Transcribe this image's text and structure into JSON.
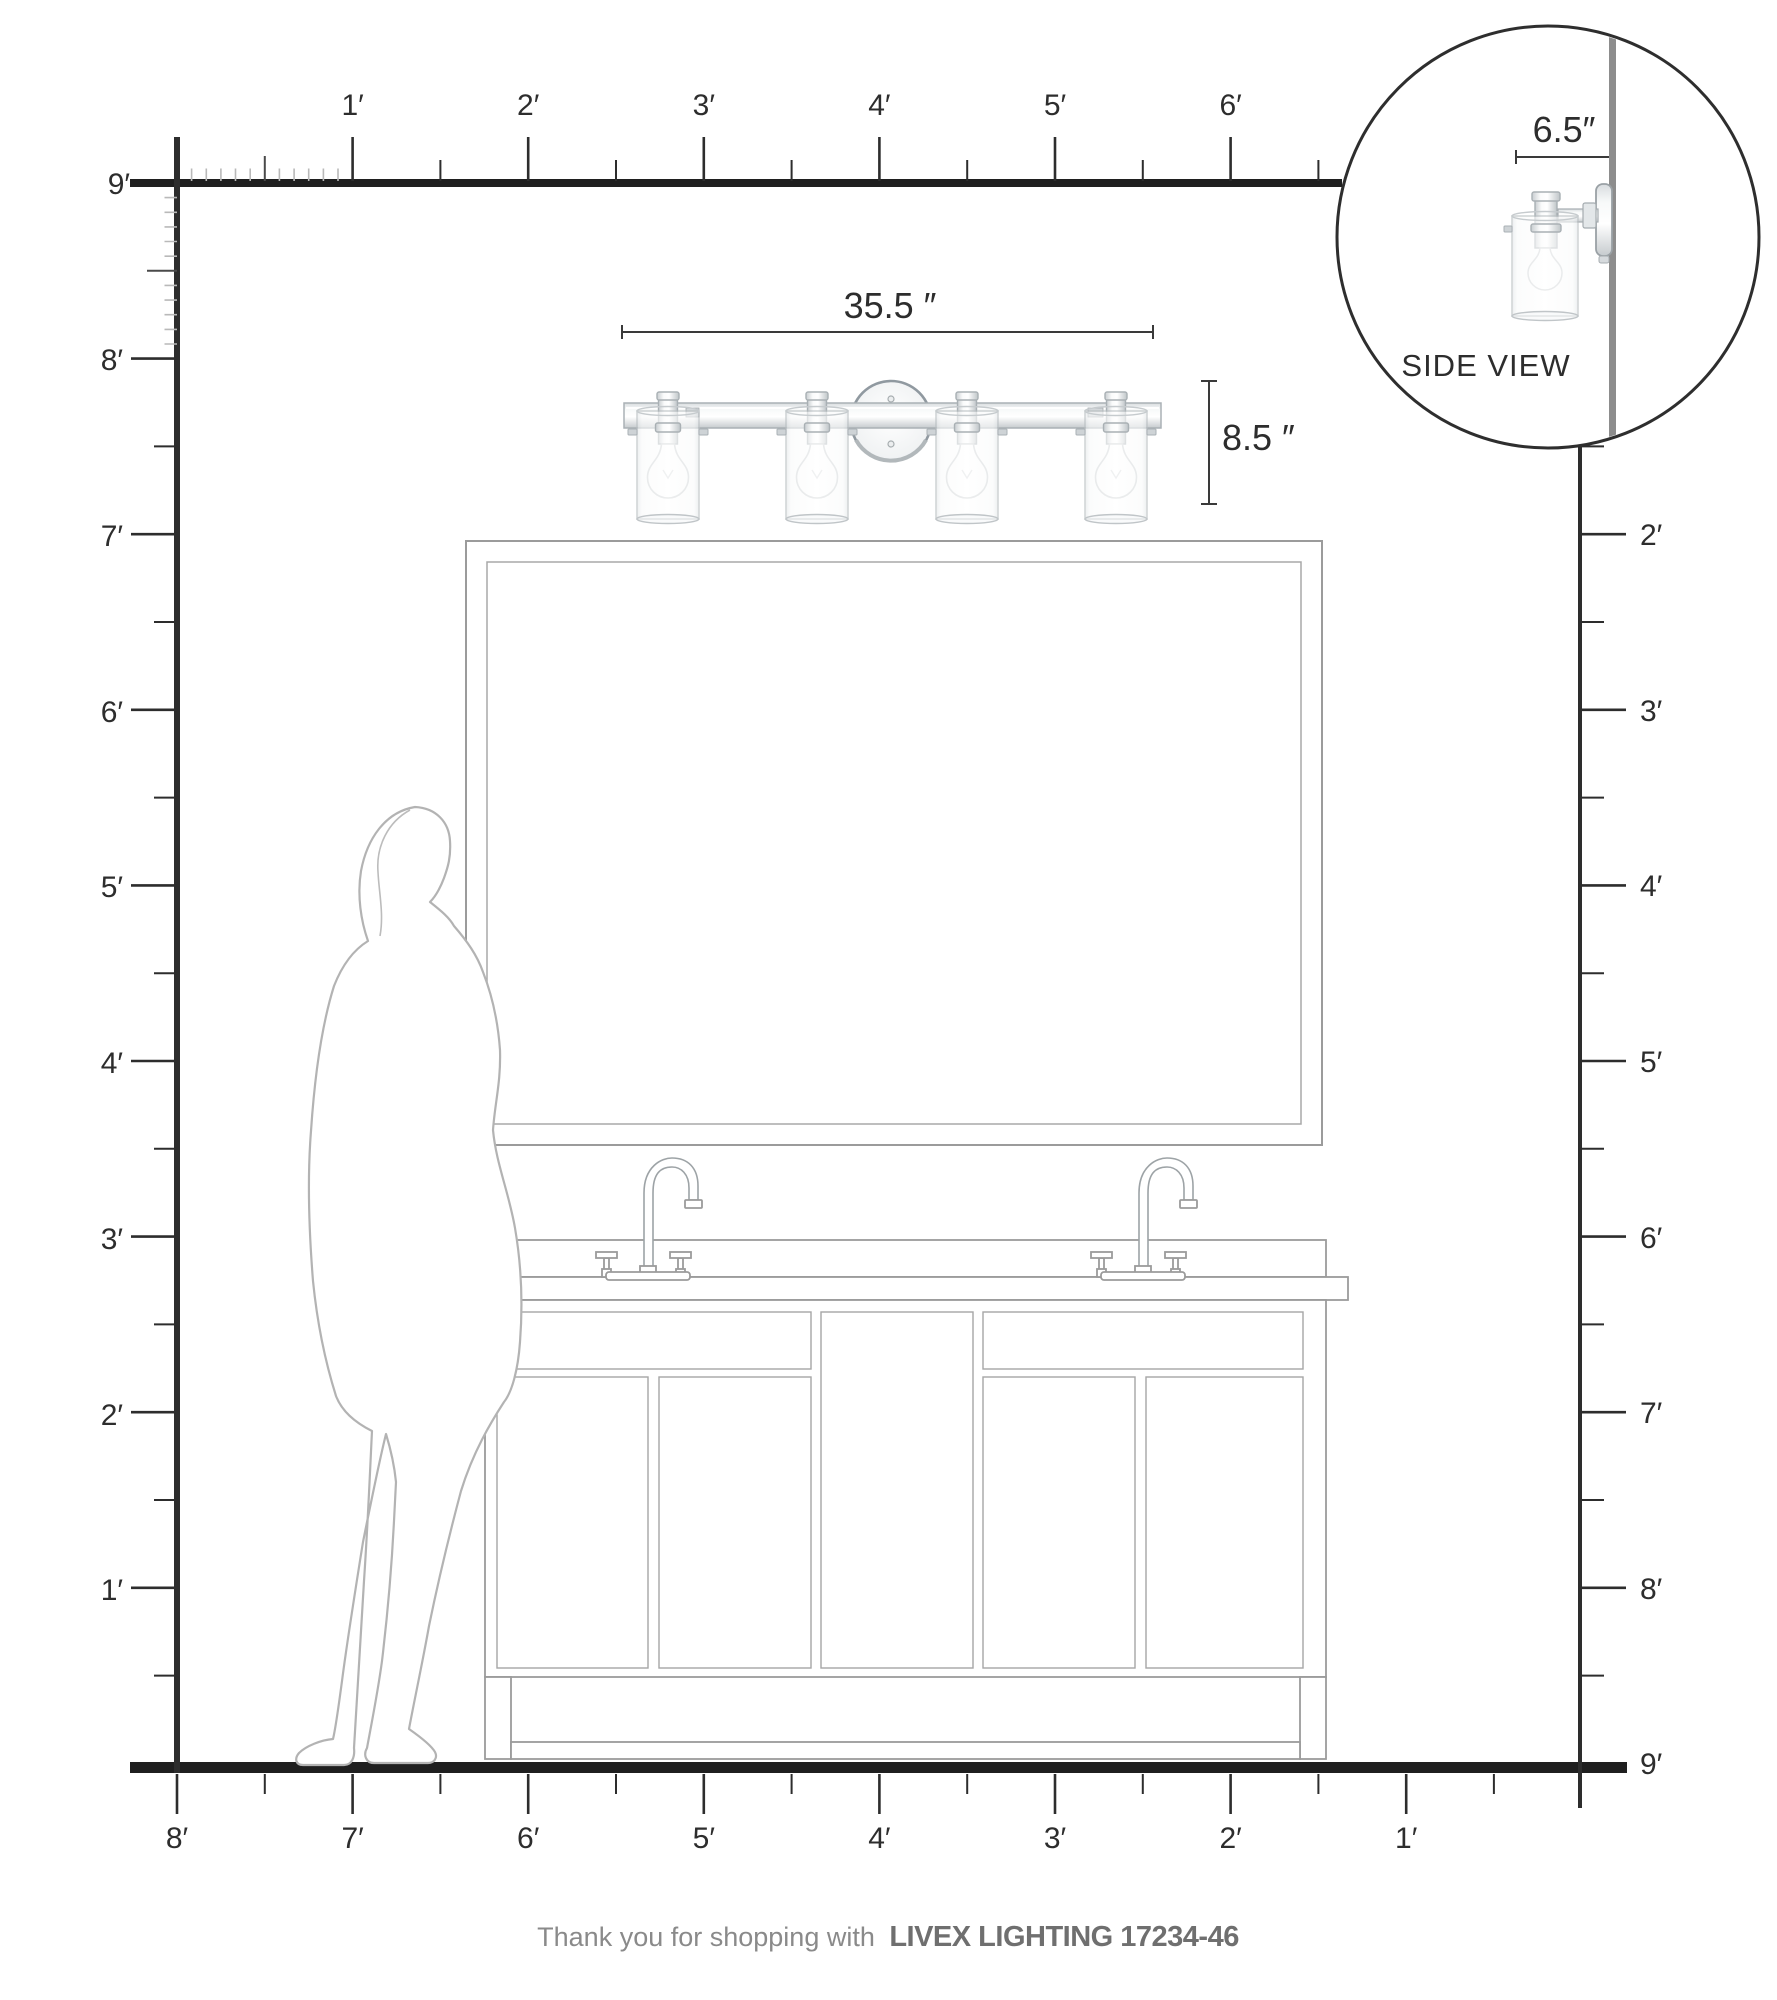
{
  "rulers": {
    "top": [
      "1′",
      "2′",
      "3′",
      "4′",
      "5′",
      "6′"
    ],
    "left": [
      "9′",
      "8′",
      "7′",
      "6′",
      "5′",
      "4′",
      "3′",
      "2′",
      "1′"
    ],
    "right": [
      "2′",
      "3′",
      "4′",
      "5′",
      "6′",
      "7′",
      "8′",
      "9′"
    ],
    "bottom": [
      "8′",
      "7′",
      "6′",
      "5′",
      "4′",
      "3′",
      "2′",
      "1′"
    ]
  },
  "dimensions": {
    "fixture_width": "35.5 ″",
    "fixture_height": "8.5 ″",
    "fixture_depth": "6.5″"
  },
  "inset": {
    "caption": "SIDE VIEW"
  },
  "footer": {
    "message": "Thank you for shopping with",
    "brand": "LIVEX LIGHTING 17234-46"
  },
  "colors": {
    "ink": "#2d2d2d",
    "outline_gray": "#9b9b9b",
    "silhouette_gray": "#b3b3b3",
    "wall_gray": "#8d8d8d",
    "footer_gray": "#7d7d7d"
  }
}
